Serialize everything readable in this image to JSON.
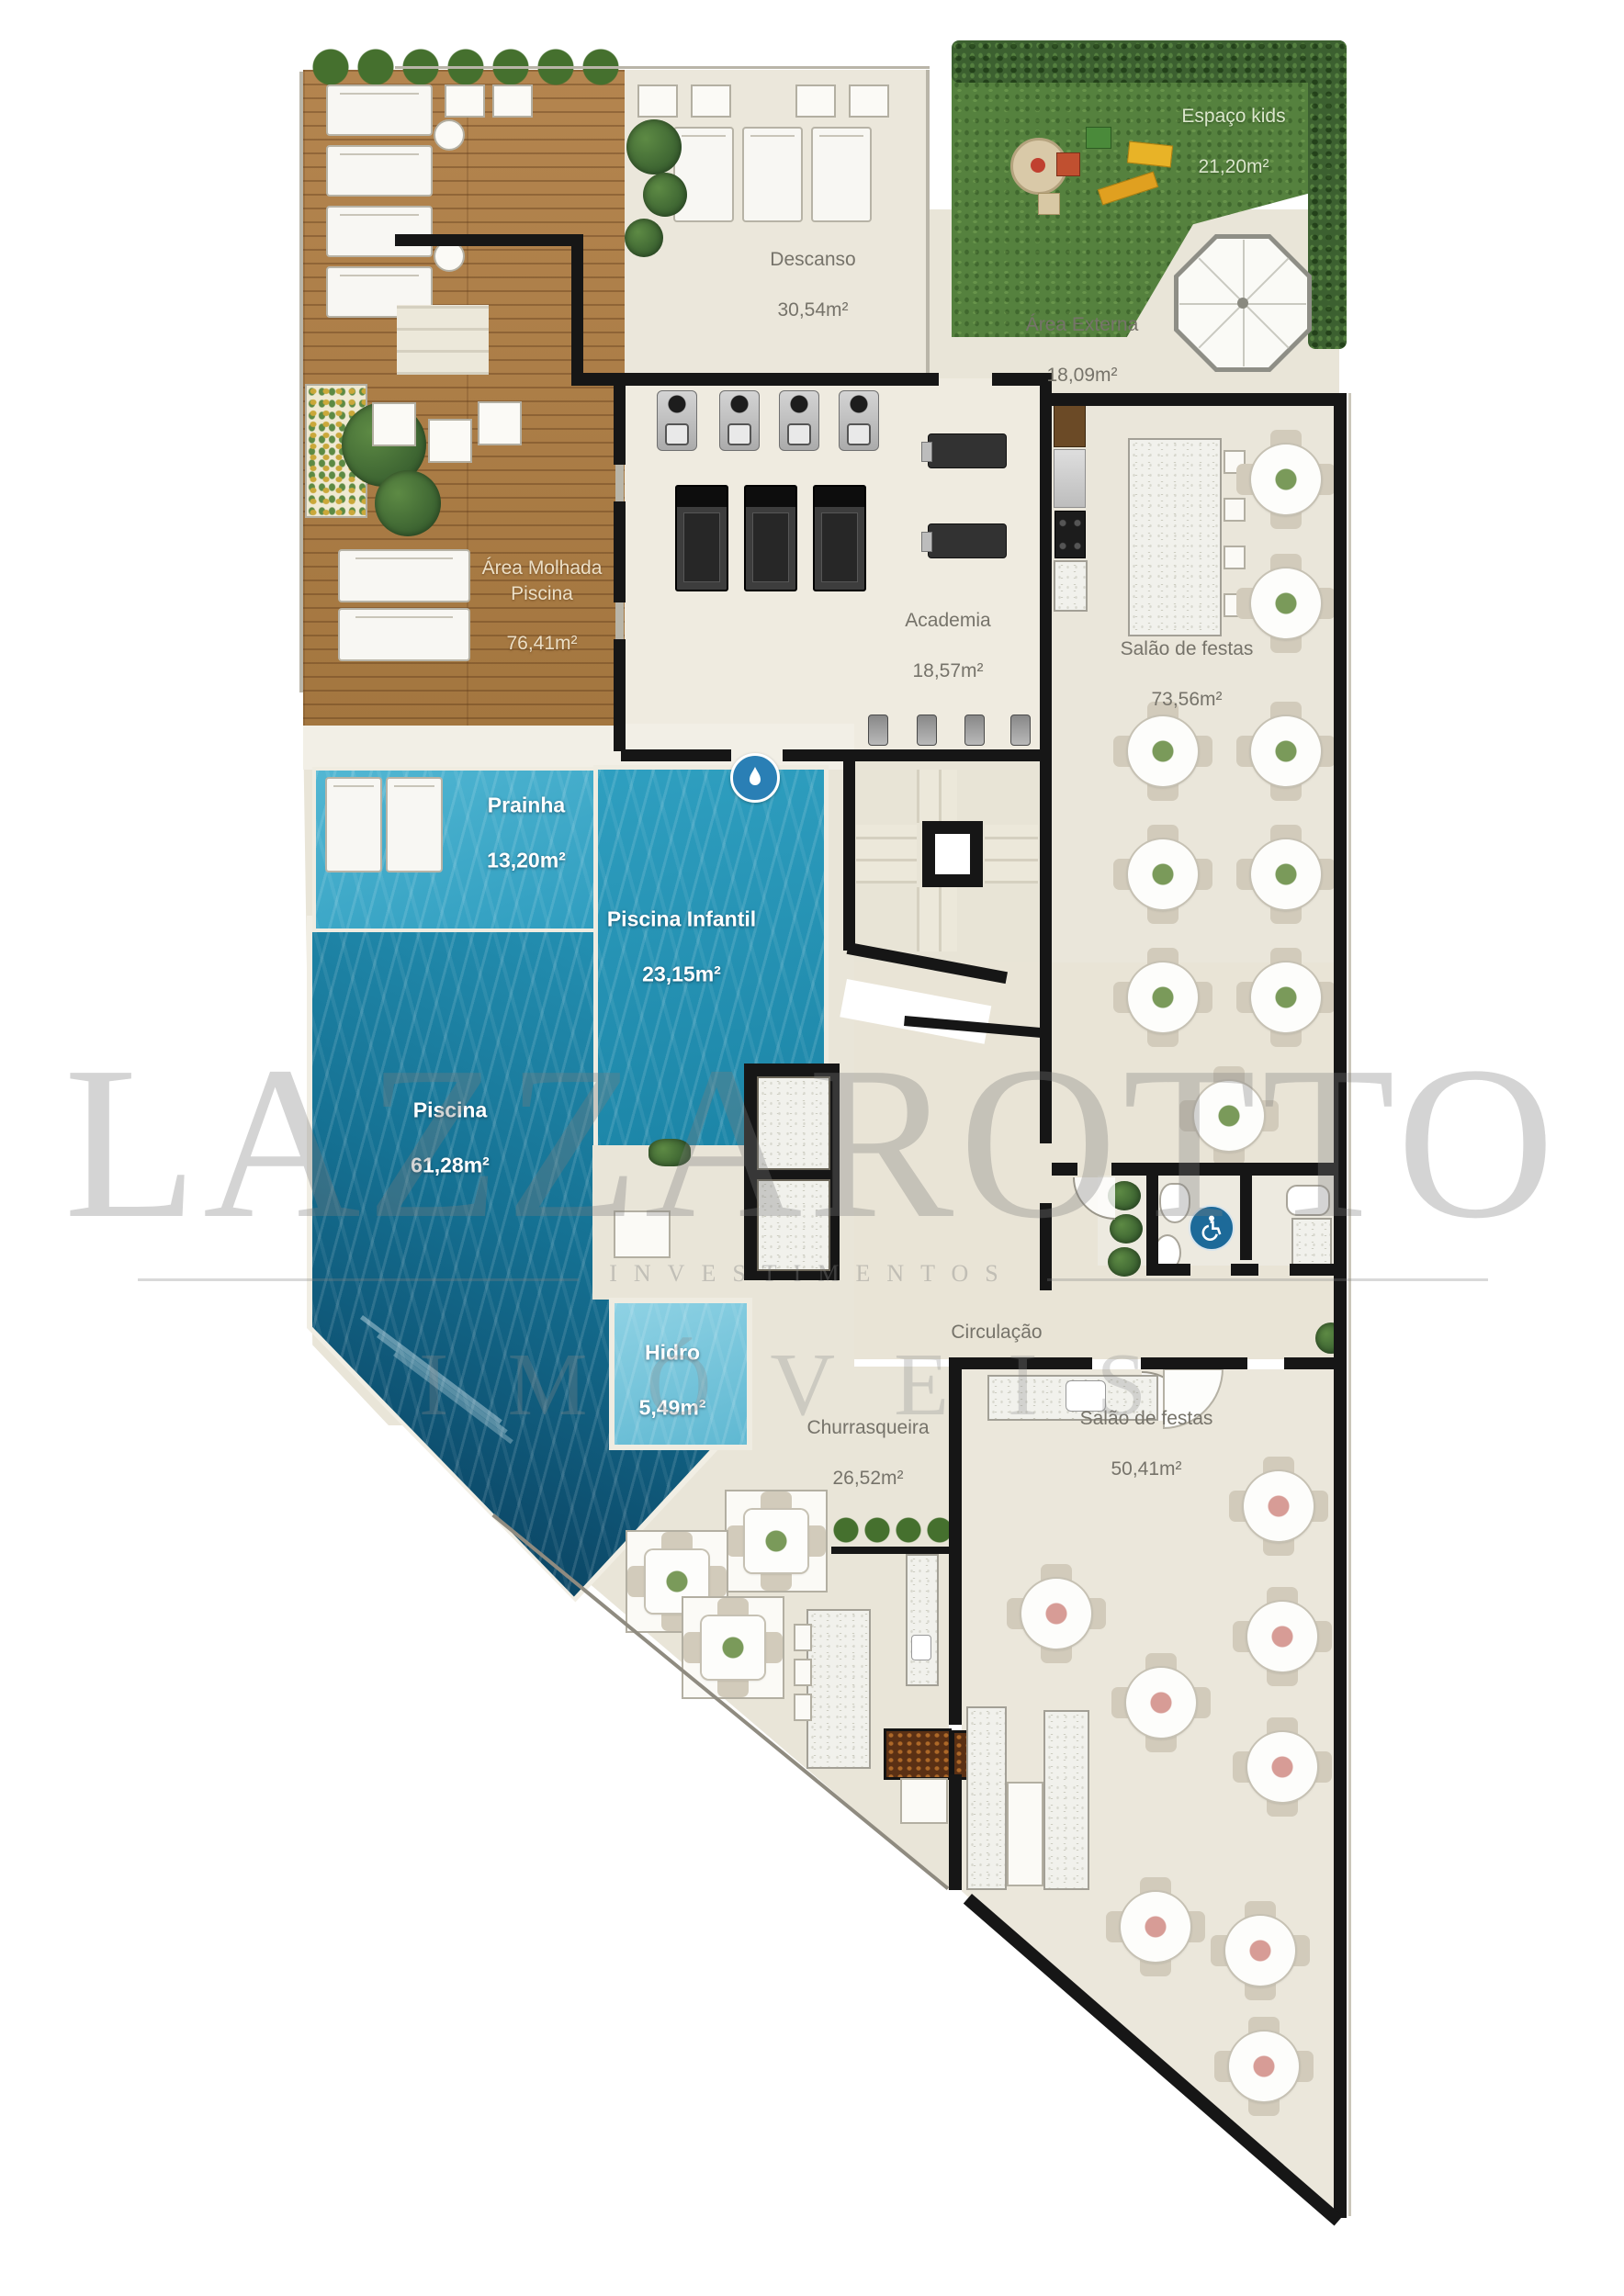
{
  "watermark": {
    "brand": "LAZZAROTTO",
    "subtitle": "INVESTIMENTOS",
    "line2": "IMÓVEIS"
  },
  "labels": {
    "area_molhada": {
      "name": "Área Molhada\nPiscina",
      "area": "76,41m²"
    },
    "descanso": {
      "name": "Descanso",
      "area": "30,54m²"
    },
    "espaco_kids": {
      "name": "Espaço kids",
      "area": "21,20m²"
    },
    "area_externa": {
      "name": "Área Externa",
      "area": "18,09m²"
    },
    "academia": {
      "name": "Academia",
      "area": "18,57m²"
    },
    "salao_superior": {
      "name": "Salão de festas",
      "area": "73,56m²"
    },
    "prainha": {
      "name": "Prainha",
      "area": "13,20m²"
    },
    "piscina_infantil": {
      "name": "Piscina Infantil",
      "area": "23,15m²"
    },
    "piscina": {
      "name": "Piscina",
      "area": "61,28m²"
    },
    "hidro": {
      "name": "Hidro",
      "area": "5,49m²"
    },
    "circulacao": {
      "name": "Circulação",
      "area": ""
    },
    "churrasqueira": {
      "name": "Churrasqueira",
      "area": "26,52m²"
    },
    "salao_inferior": {
      "name": "Salão de festas",
      "area": "50,41m²"
    }
  },
  "icons": {
    "accessible": "wheelchair-icon",
    "pool_entry": "water-drop-icon"
  },
  "palette": {
    "wall": "#161616",
    "floor_beige": "#eae6da",
    "wood_deck": "#ad7c4a",
    "grass": "#55813e",
    "hedge": "#3c6030",
    "water_main": "#157193",
    "water_shallow": "#45aecb",
    "water_infantil": "#2395b6",
    "water_hidro": "#7ccadf",
    "marble": "#f1f1ec",
    "accessible_blue": "#1d6a99"
  }
}
